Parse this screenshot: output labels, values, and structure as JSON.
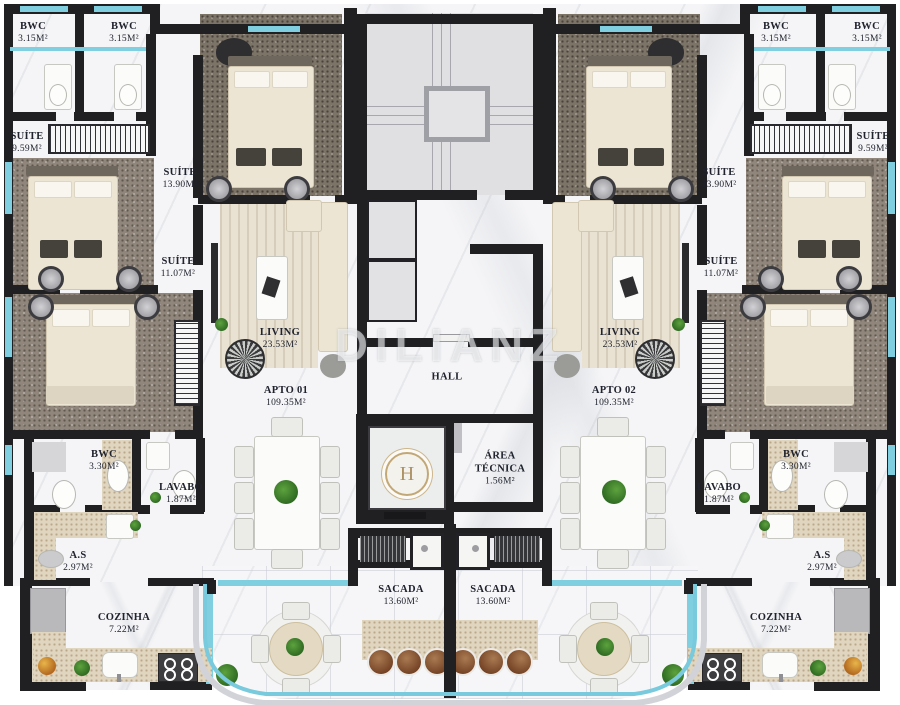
{
  "watermark": {
    "text": "DILIANZ"
  },
  "elevator": {
    "monogram": "H"
  },
  "colors": {
    "wall": "#202023",
    "glass": "#7fcfe1",
    "floor_marble": "#f5f5f7",
    "carpet": "#90867b",
    "bed": "#ece5d3",
    "counter_speckle": "#e0d5bf",
    "stool_leather": "#8a5a38",
    "plant_green": "#3c7d2b",
    "gold_monogram": "#c3a877"
  },
  "room_labels": [
    {
      "id": "bwc-top-left-1",
      "name": "BWC",
      "area": "3.15M²",
      "x": 33,
      "y": 33
    },
    {
      "id": "bwc-top-left-2",
      "name": "BWC",
      "area": "3.15M²",
      "x": 124,
      "y": 33
    },
    {
      "id": "bwc-top-right-1",
      "name": "BWC",
      "area": "3.15M²",
      "x": 776,
      "y": 33
    },
    {
      "id": "bwc-top-right-2",
      "name": "BWC",
      "area": "3.15M²",
      "x": 867,
      "y": 33
    },
    {
      "id": "suite-959-left",
      "name": "SUÍTE",
      "area": "9.59M²",
      "x": 27,
      "y": 143
    },
    {
      "id": "suite-959-right",
      "name": "SUÍTE",
      "area": "9.59M²",
      "x": 873,
      "y": 143
    },
    {
      "id": "suite-1390-left",
      "name": "SUÍTE",
      "area": "13.90M²",
      "x": 180,
      "y": 179
    },
    {
      "id": "suite-1390-right",
      "name": "SUÍTE",
      "area": "13.90M²",
      "x": 719,
      "y": 179
    },
    {
      "id": "suite-1107-left",
      "name": "SUÍTE",
      "area": "11.07M²",
      "x": 178,
      "y": 268
    },
    {
      "id": "suite-1107-right",
      "name": "SUÍTE",
      "area": "11.07M²",
      "x": 721,
      "y": 268
    },
    {
      "id": "living-left",
      "name": "LIVING",
      "area": "23.53M²",
      "x": 280,
      "y": 339
    },
    {
      "id": "living-right",
      "name": "LIVING",
      "area": "23.53M²",
      "x": 620,
      "y": 339
    },
    {
      "id": "hall",
      "name": "HALL",
      "area": "",
      "x": 447,
      "y": 378
    },
    {
      "id": "apto-01",
      "name": "APTO 01",
      "area": "109.35M²",
      "x": 286,
      "y": 397
    },
    {
      "id": "apto-02",
      "name": "APTO 02",
      "area": "109.35M²",
      "x": 614,
      "y": 397
    },
    {
      "id": "bwc-mid-left",
      "name": "BWC",
      "area": "3.30M²",
      "x": 104,
      "y": 461
    },
    {
      "id": "bwc-mid-right",
      "name": "BWC",
      "area": "3.30M²",
      "x": 796,
      "y": 461
    },
    {
      "id": "lavabo-left",
      "name": "LAVABO",
      "area": "1.87M²",
      "x": 181,
      "y": 494
    },
    {
      "id": "lavabo-right",
      "name": "LAVABO",
      "area": "1.87M²",
      "x": 719,
      "y": 494
    },
    {
      "id": "area-tecnica",
      "name": "ÁREA TÉCNICA",
      "area": "1.56M²",
      "x": 500,
      "y": 469,
      "w": 60
    },
    {
      "id": "as-left",
      "name": "A.S",
      "area": "2.97M²",
      "x": 78,
      "y": 562
    },
    {
      "id": "as-right",
      "name": "A.S",
      "area": "2.97M²",
      "x": 822,
      "y": 562
    },
    {
      "id": "cozinha-left",
      "name": "COZINHA",
      "area": "7.22M²",
      "x": 124,
      "y": 624
    },
    {
      "id": "cozinha-right",
      "name": "COZINHA",
      "area": "7.22M²",
      "x": 776,
      "y": 624
    },
    {
      "id": "sacada-left",
      "name": "SACADA",
      "area": "13.60M²",
      "x": 401,
      "y": 596,
      "w": 60
    },
    {
      "id": "sacada-right",
      "name": "SACADA",
      "area": "13.60M²",
      "x": 493,
      "y": 596,
      "w": 60
    }
  ]
}
